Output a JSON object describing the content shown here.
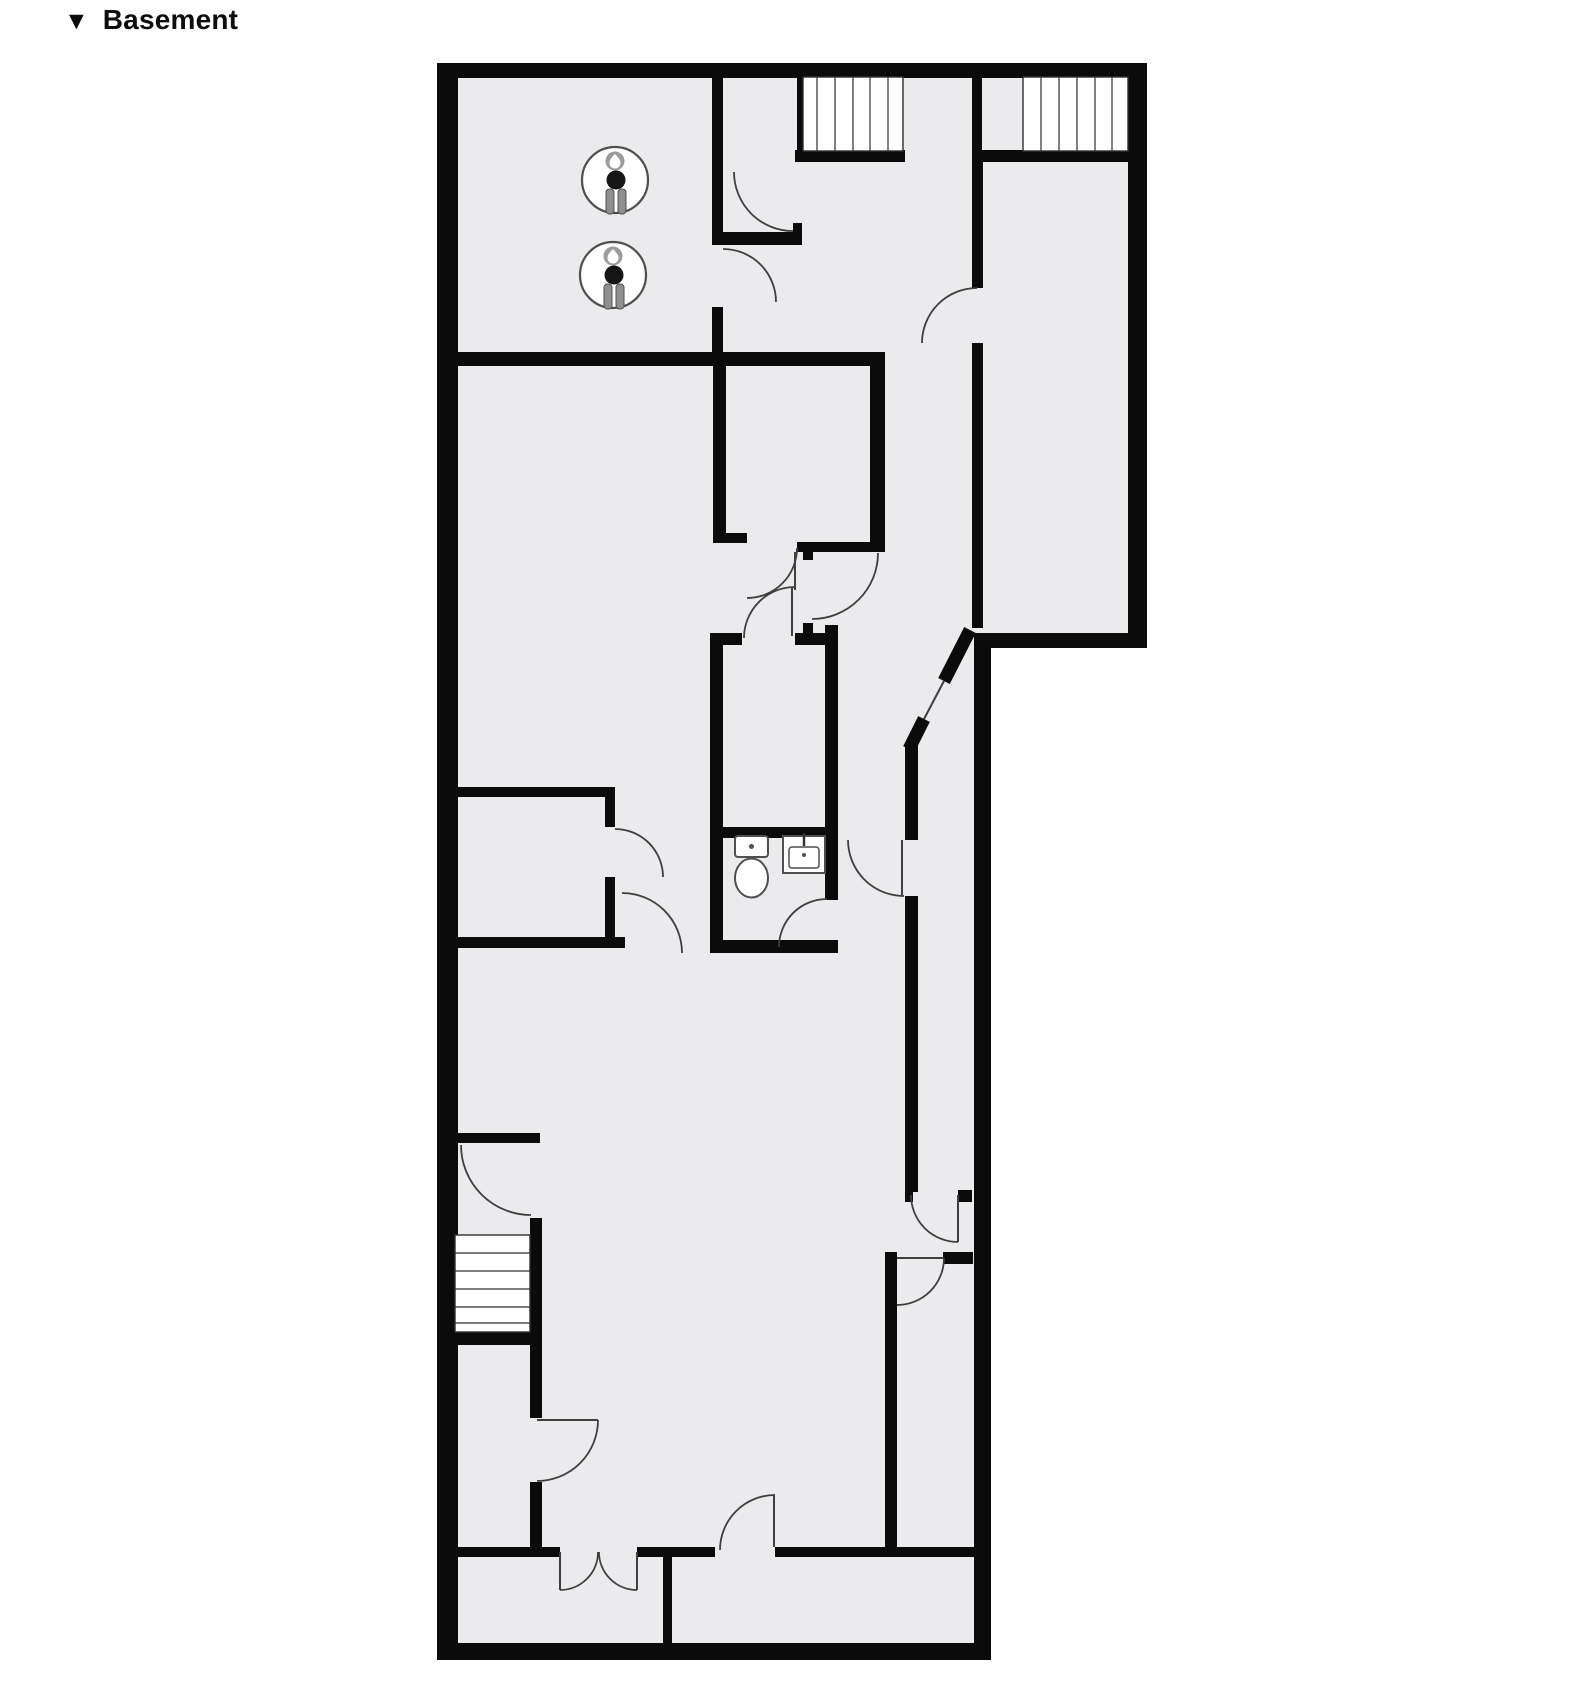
{
  "header": {
    "marker": "▼",
    "title": "Basement"
  },
  "floorplan": {
    "canvas": {
      "width": 1583,
      "height": 1689
    },
    "colors": {
      "wall": "#0b0b0b",
      "floor": "#ebebed",
      "door": "#3f3f3f",
      "tread": "#2f2f2f",
      "fixture_stroke": "#4f4f4f",
      "fixture_gray": "#8f8f8f",
      "fixture_dark": "#151515",
      "badge_gray": "#9c9c9c"
    },
    "floor_outline": {
      "name": "floor-area",
      "points": "M437 63 L1147 63 L1147 648 L991 648 L991 1660 L437 1660 Z"
    },
    "outer_walls": [
      {
        "name": "outer-wall-top",
        "x": 437,
        "y": 63,
        "w": 710,
        "h": 15
      },
      {
        "name": "outer-wall-left",
        "x": 437,
        "y": 63,
        "w": 21,
        "h": 1597
      },
      {
        "name": "outer-wall-ext-right",
        "x": 1128,
        "y": 63,
        "w": 19,
        "h": 585
      },
      {
        "name": "outer-wall-ext-bottom",
        "x": 983,
        "y": 633,
        "w": 164,
        "h": 15
      },
      {
        "name": "outer-wall-right",
        "x": 974,
        "y": 633,
        "w": 17,
        "h": 1027
      },
      {
        "name": "outer-wall-bottom",
        "x": 437,
        "y": 1643,
        "w": 554,
        "h": 17
      }
    ],
    "inner_walls": [
      {
        "name": "wall-a-upper",
        "x": 712,
        "y": 77,
        "w": 11,
        "h": 168
      },
      {
        "name": "vestibule-bottom-wall",
        "x": 712,
        "y": 232,
        "w": 90,
        "h": 13
      },
      {
        "name": "vestibule-nub",
        "x": 793,
        "y": 223,
        "w": 9,
        "h": 9
      },
      {
        "name": "wall-a-lower",
        "x": 712,
        "y": 307,
        "w": 11,
        "h": 46
      },
      {
        "name": "wall-h1",
        "x": 455,
        "y": 352,
        "w": 430,
        "h": 14
      },
      {
        "name": "stair1-side-wall",
        "x": 797,
        "y": 77,
        "w": 10,
        "h": 80
      },
      {
        "name": "stair1-landing-wall",
        "x": 795,
        "y": 150,
        "w": 110,
        "h": 12
      },
      {
        "name": "stair2-landing-wall",
        "x": 972,
        "y": 150,
        "w": 156,
        "h": 12
      },
      {
        "name": "wall-b-top",
        "x": 972,
        "y": 77,
        "w": 10,
        "h": 80
      },
      {
        "name": "wall-b-mid",
        "x": 972,
        "y": 160,
        "w": 11,
        "h": 128
      },
      {
        "name": "wall-b-low",
        "x": 972,
        "y": 343,
        "w": 11,
        "h": 285
      },
      {
        "name": "smallroom-left-wall",
        "x": 713,
        "y": 366,
        "w": 13,
        "h": 177
      },
      {
        "name": "smallroom-right-wall",
        "x": 870,
        "y": 366,
        "w": 15,
        "h": 186
      },
      {
        "name": "smallroom-bottom-left",
        "x": 713,
        "y": 533,
        "w": 34,
        "h": 10
      },
      {
        "name": "smallroom-bottom-right",
        "x": 797,
        "y": 542,
        "w": 88,
        "h": 10
      },
      {
        "name": "smallroom-hinge-nub",
        "x": 803,
        "y": 552,
        "w": 10,
        "h": 8
      },
      {
        "name": "closet-top-left",
        "x": 713,
        "y": 633,
        "w": 29,
        "h": 12
      },
      {
        "name": "closet-top-right",
        "x": 795,
        "y": 633,
        "w": 42,
        "h": 12
      },
      {
        "name": "closet-hinge-nub",
        "x": 803,
        "y": 623,
        "w": 10,
        "h": 10
      },
      {
        "name": "bath-left-wall",
        "x": 710,
        "y": 633,
        "w": 13,
        "h": 320
      },
      {
        "name": "bath-right-wall",
        "x": 825,
        "y": 625,
        "w": 13,
        "h": 275
      },
      {
        "name": "bath-top-wall",
        "x": 710,
        "y": 827,
        "w": 128,
        "h": 11
      },
      {
        "name": "bath-bottom-wall",
        "x": 710,
        "y": 940,
        "w": 128,
        "h": 13
      },
      {
        "name": "chase-wall-upper",
        "x": 905,
        "y": 745,
        "w": 13,
        "h": 95
      },
      {
        "name": "chase-wall-lower",
        "x": 905,
        "y": 896,
        "w": 13,
        "h": 296
      },
      {
        "name": "junction-nub-left",
        "x": 905,
        "y": 1190,
        "w": 8,
        "h": 12
      },
      {
        "name": "junction-nub-right",
        "x": 958,
        "y": 1190,
        "w": 14,
        "h": 12
      },
      {
        "name": "junction2-nub",
        "x": 943,
        "y": 1252,
        "w": 30,
        "h": 12
      },
      {
        "name": "wall-d",
        "x": 885,
        "y": 1252,
        "w": 12,
        "h": 295
      },
      {
        "name": "leftroom-top-wall",
        "x": 457,
        "y": 787,
        "w": 158,
        "h": 10
      },
      {
        "name": "leftroom-right-wall-a",
        "x": 605,
        "y": 797,
        "w": 10,
        "h": 30
      },
      {
        "name": "leftroom-right-wall-b",
        "x": 605,
        "y": 877,
        "w": 10,
        "h": 60
      },
      {
        "name": "leftroom-bottom-wall",
        "x": 457,
        "y": 937,
        "w": 168,
        "h": 11
      },
      {
        "name": "stairs3-top-nub",
        "x": 453,
        "y": 1133,
        "w": 87,
        "h": 10
      },
      {
        "name": "stairs3-bottom-bar",
        "x": 453,
        "y": 1332,
        "w": 87,
        "h": 13
      },
      {
        "name": "wall-e-upper",
        "x": 530,
        "y": 1218,
        "w": 12,
        "h": 200
      },
      {
        "name": "wall-e-lower",
        "x": 530,
        "y": 1482,
        "w": 12,
        "h": 65
      },
      {
        "name": "bottomrow-wall-a",
        "x": 453,
        "y": 1547,
        "w": 107,
        "h": 10
      },
      {
        "name": "bottomrow-wall-b",
        "x": 637,
        "y": 1547,
        "w": 78,
        "h": 10
      },
      {
        "name": "bottomrow-wall-c",
        "x": 775,
        "y": 1547,
        "w": 199,
        "h": 10
      },
      {
        "name": "bottomrow-divider",
        "x": 663,
        "y": 1557,
        "w": 9,
        "h": 86
      }
    ],
    "diagonal_walls": [
      {
        "name": "diag-wall-upper",
        "x1": 970,
        "y1": 630,
        "x2": 944,
        "y2": 681,
        "w": 13
      },
      {
        "name": "diag-wall-lower",
        "x1": 924,
        "y1": 719,
        "x2": 909,
        "y2": 749,
        "w": 13
      }
    ],
    "stairs": [
      {
        "name": "staircase-top-left",
        "x": 803,
        "y": 77,
        "w": 100,
        "h": 74,
        "orient": "v",
        "lines": [
          817,
          835,
          853,
          870,
          888
        ]
      },
      {
        "name": "staircase-top-right",
        "x": 1023,
        "y": 77,
        "w": 105,
        "h": 74,
        "orient": "v",
        "lines": [
          1041,
          1059,
          1077,
          1095,
          1112
        ]
      },
      {
        "name": "staircase-mid-left",
        "x": 455,
        "y": 1235,
        "w": 75,
        "h": 97,
        "orient": "h",
        "lines": [
          1253,
          1271,
          1289,
          1307,
          1323
        ]
      }
    ],
    "door_arcs": [
      {
        "name": "door-arc-vestibule",
        "d": "M734 172 A59 59 0 0 0 793 231"
      },
      {
        "name": "door-arc-heater-room",
        "d": "M723 249 A53 53 0 0 1 776 302"
      },
      {
        "name": "door-arc-extension",
        "d": "M922 343 A55 55 0 0 1 977 288"
      },
      {
        "name": "door-arc-smallroom",
        "d": "M797 548 A50 50 0 0 1 747 598"
      },
      {
        "name": "door-arc-corridor",
        "d": "M878 553 A66 66 0 0 1 812 619"
      },
      {
        "name": "door-arc-closet",
        "d": "M795 587 A51 51 0 0 0 744 638"
      },
      {
        "name": "door-arc-leftroom",
        "d": "M615 829 A48 48 0 0 1 663 877"
      },
      {
        "name": "door-arc-leftroom-2",
        "d": "M622 893 A60 60 0 0 1 682 953"
      },
      {
        "name": "door-arc-bathroom",
        "d": "M779 947 A48 48 0 0 1 827 899"
      },
      {
        "name": "door-arc-chase",
        "d": "M904 896 A56 56 0 0 1 848 840"
      },
      {
        "name": "door-arc-junction-1",
        "d": "M911 1195 A47 47 0 0 0 958 1242"
      },
      {
        "name": "door-arc-junction-2",
        "d": "M944 1258 A47 47 0 0 1 897 1305"
      },
      {
        "name": "door-arc-stairs3",
        "d": "M461 1145 A70 70 0 0 0 531 1215"
      },
      {
        "name": "door-arc-stairs-closet",
        "d": "M598 1420 A61 61 0 0 1 537 1481"
      },
      {
        "name": "door-arc-double-left",
        "d": "M598 1552 A38 38 0 0 1 560 1590"
      },
      {
        "name": "door-arc-double-right",
        "d": "M599 1552 A38 38 0 0 0 637 1590"
      },
      {
        "name": "door-arc-bottom-room",
        "d": "M720 1550 A55 55 0 0 1 775 1495"
      }
    ],
    "door_leaves": [
      {
        "name": "leaf-corridor",
        "x1": 795,
        "y1": 552,
        "x2": 795,
        "y2": 590
      },
      {
        "name": "leaf-closet",
        "x1": 792,
        "y1": 588,
        "x2": 792,
        "y2": 636
      },
      {
        "name": "leaf-chase",
        "x1": 902,
        "y1": 840,
        "x2": 902,
        "y2": 896
      },
      {
        "name": "leaf-junction-1",
        "x1": 958,
        "y1": 1195,
        "x2": 958,
        "y2": 1242
      },
      {
        "name": "leaf-junction-2",
        "x1": 897,
        "y1": 1258,
        "x2": 944,
        "y2": 1258
      },
      {
        "name": "leaf-stairs-closet",
        "x1": 537,
        "y1": 1420,
        "x2": 598,
        "y2": 1420
      },
      {
        "name": "leaf-double-left",
        "x1": 560,
        "y1": 1552,
        "x2": 560,
        "y2": 1590
      },
      {
        "name": "leaf-double-right",
        "x1": 637,
        "y1": 1552,
        "x2": 637,
        "y2": 1590
      },
      {
        "name": "leaf-bottom-room",
        "x1": 774,
        "y1": 1495,
        "x2": 774,
        "y2": 1547
      },
      {
        "name": "leaf-diagonal-door",
        "x1": 944,
        "y1": 681,
        "x2": 924,
        "y2": 719
      }
    ],
    "water_heaters": [
      {
        "name": "water-heater-icon-1",
        "cx": 615,
        "cy": 180
      },
      {
        "name": "water-heater-icon-2",
        "cx": 613,
        "cy": 275
      }
    ],
    "toilet": {
      "name": "toilet-icon",
      "tank_x": 735,
      "tank_y": 836,
      "tank_w": 33,
      "tank_h": 21,
      "bowl_cx": 751.5,
      "bowl_cy": 878,
      "bowl_rx": 16.5,
      "bowl_ry": 19.5
    },
    "sink": {
      "name": "sink-icon",
      "x": 783,
      "y": 836,
      "w": 42,
      "h": 37,
      "inner_x": 789,
      "inner_y": 847,
      "inner_w": 30,
      "inner_h": 21
    }
  }
}
